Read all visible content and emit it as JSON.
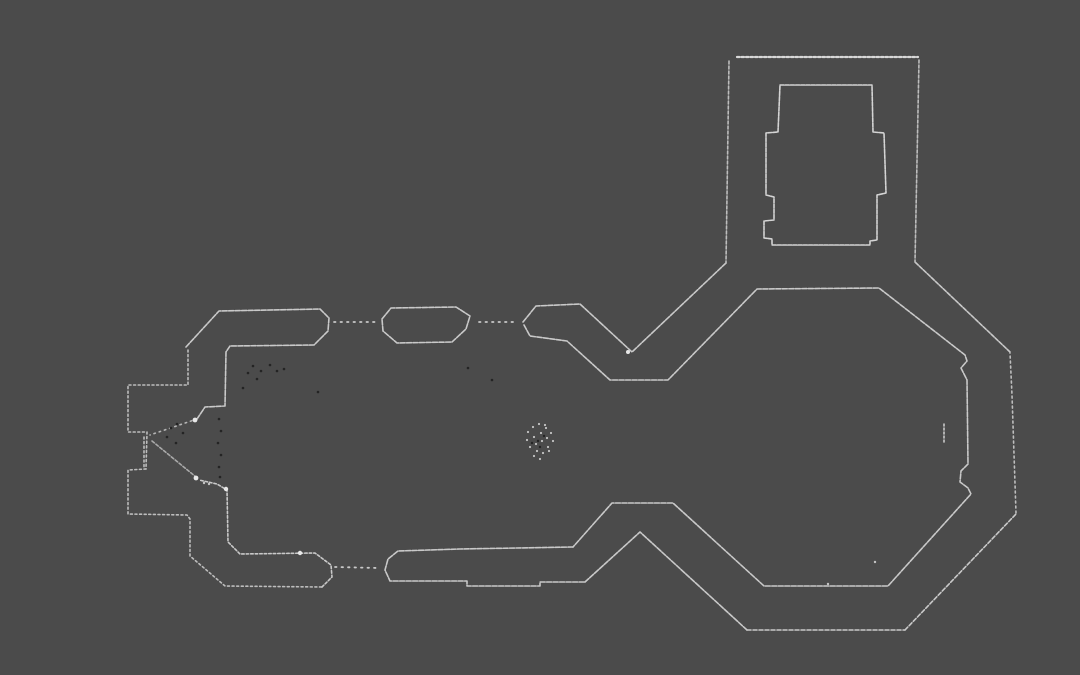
{
  "canvas": {
    "width": 1080,
    "height": 675,
    "background_color": "#4b4b4b",
    "wall_color": "#c9c9c9",
    "bright_color": "#e8e8e8",
    "noise_dark_color": "#242424",
    "noise_light_color": "#c4c4c4"
  },
  "map": {
    "walls": [
      {
        "name": "wall-nave-north-west-band",
        "dash": "5 1.5",
        "points": [
          [
            186,
            347
          ],
          [
            219,
            311
          ],
          [
            320,
            309
          ],
          [
            329,
            318
          ],
          [
            328,
            331
          ],
          [
            314,
            345
          ],
          [
            230,
            346
          ],
          [
            226,
            352
          ],
          [
            225,
            406
          ],
          [
            205,
            407
          ],
          [
            197,
            419
          ]
        ]
      },
      {
        "name": "wall-west-front-north-outer",
        "dash": "2 2.6",
        "color": "#bdbdbd",
        "points": [
          [
            188,
            350
          ],
          [
            188,
            385
          ],
          [
            128,
            385
          ],
          [
            128,
            432
          ],
          [
            147,
            432
          ],
          [
            146,
            469
          ]
        ]
      },
      {
        "name": "wall-west-front-south-outer",
        "dash": "2 2.6",
        "color": "#bdbdbd",
        "points": [
          [
            146,
            469
          ],
          [
            128,
            470
          ],
          [
            128,
            514
          ],
          [
            187,
            515
          ],
          [
            190,
            519
          ],
          [
            190,
            556
          ],
          [
            225,
            586
          ],
          [
            322,
            587
          ]
        ]
      },
      {
        "name": "wall-southwest-inner-cap",
        "dash": "2.5 2",
        "points": [
          [
            322,
            587
          ],
          [
            332,
            577
          ],
          [
            331,
            565
          ],
          [
            315,
            553
          ],
          [
            240,
            554
          ],
          [
            228,
            542
          ],
          [
            227,
            490
          ],
          [
            217,
            484
          ],
          [
            199,
            480
          ]
        ]
      },
      {
        "name": "west-door-leaf",
        "dash": "3 2",
        "color": "#a9a9a9",
        "points": [
          [
            152,
            441
          ],
          [
            196,
            477
          ]
        ]
      },
      {
        "name": "west-door-splay-top",
        "dash": "1.5 4",
        "color": "#b5b5b5",
        "points": [
          [
            197,
            419
          ],
          [
            150,
            435
          ]
        ]
      },
      {
        "name": "west-door-frame",
        "dash": "2 2.6",
        "color": "#bdbdbd",
        "points": [
          [
            144,
            437
          ],
          [
            144,
            468
          ]
        ]
      },
      {
        "name": "window-gap-dots-north-1",
        "dash": "1.5 5",
        "width": 1.8,
        "points": [
          [
            334,
            322
          ],
          [
            376,
            322
          ]
        ]
      },
      {
        "name": "window-pier-north",
        "dash": "5 1.5",
        "closed": true,
        "points": [
          [
            382,
            319
          ],
          [
            391,
            308
          ],
          [
            456,
            307
          ],
          [
            470,
            316
          ],
          [
            466,
            329
          ],
          [
            452,
            342
          ],
          [
            397,
            343
          ],
          [
            383,
            331
          ]
        ]
      },
      {
        "name": "window-gap-dots-north-2",
        "dash": "1.5 5",
        "width": 1.8,
        "points": [
          [
            479,
            322
          ],
          [
            518,
            322
          ]
        ]
      },
      {
        "name": "wall-nave-north-east-outer",
        "dash": "5 1.5",
        "points": [
          [
            523,
            322
          ],
          [
            536,
            306
          ],
          [
            580,
            304
          ],
          [
            632,
            352
          ],
          [
            726,
            263
          ]
        ]
      },
      {
        "name": "wall-octagon-inner-boundary",
        "dash": "5 1.5",
        "points": [
          [
            524,
            325
          ],
          [
            530,
            336
          ],
          [
            567,
            341
          ],
          [
            610,
            380
          ],
          [
            668,
            380
          ],
          [
            757,
            289
          ],
          [
            879,
            288
          ],
          [
            965,
            355
          ],
          [
            967,
            361
          ],
          [
            961,
            368
          ],
          [
            964,
            374
          ],
          [
            967,
            380
          ],
          [
            968,
            464
          ],
          [
            961,
            471
          ],
          [
            960,
            482
          ],
          [
            968,
            488
          ],
          [
            971,
            494
          ],
          [
            888,
            586
          ],
          [
            764,
            586
          ],
          [
            673,
            503
          ],
          [
            612,
            503
          ],
          [
            573,
            547
          ]
        ]
      },
      {
        "name": "wall-nave-south-band",
        "dash": "5 1.5",
        "points": [
          [
            573,
            547
          ],
          [
            460,
            549
          ],
          [
            398,
            551
          ],
          [
            388,
            559
          ],
          [
            385,
            570
          ],
          [
            390,
            581
          ],
          [
            467,
            581
          ],
          [
            467,
            586
          ],
          [
            540,
            586
          ],
          [
            540,
            582
          ],
          [
            585,
            582
          ]
        ]
      },
      {
        "name": "wall-octagon-outer-southwest",
        "dash": "5 1.5",
        "points": [
          [
            585,
            582
          ],
          [
            640,
            532
          ],
          [
            747,
            630
          ]
        ]
      },
      {
        "name": "wall-octagon-outer-south",
        "dash": "4 2",
        "points": [
          [
            747,
            630
          ],
          [
            905,
            630
          ]
        ]
      },
      {
        "name": "wall-octagon-outer-southeast",
        "dash": "4 2",
        "points": [
          [
            905,
            630
          ],
          [
            1016,
            514
          ]
        ]
      },
      {
        "name": "wall-octagon-outer-east",
        "dash": "2 3",
        "color": "#bdbdbd",
        "points": [
          [
            1016,
            513
          ],
          [
            1012,
            395
          ],
          [
            1010,
            353
          ]
        ]
      },
      {
        "name": "wall-octagon-outer-northeast",
        "dash": "4 1.5",
        "points": [
          [
            1010,
            352
          ],
          [
            915,
            262
          ]
        ]
      },
      {
        "name": "wall-tower-east",
        "dash": "3 2",
        "color": "#bdbdbd",
        "points": [
          [
            919,
            60
          ],
          [
            915,
            262
          ]
        ]
      },
      {
        "name": "wall-tower-north",
        "dash": "2.5 2",
        "width": 2.2,
        "color": "#d8d8d8",
        "points": [
          [
            737,
            57
          ],
          [
            918,
            57
          ]
        ]
      },
      {
        "name": "wall-tower-west",
        "dash": "3 2",
        "color": "#bdbdbd",
        "points": [
          [
            729,
            61
          ],
          [
            726,
            263
          ]
        ]
      },
      {
        "name": "tower-core-cross",
        "dash": "4 1.2",
        "color": "#d4d4d4",
        "closed": true,
        "points": [
          [
            780,
            85
          ],
          [
            872,
            85
          ],
          [
            873,
            132
          ],
          [
            884,
            133
          ],
          [
            886,
            193
          ],
          [
            877,
            195
          ],
          [
            877,
            240
          ],
          [
            870,
            241
          ],
          [
            870,
            245
          ],
          [
            772,
            245
          ],
          [
            772,
            239
          ],
          [
            764,
            238
          ],
          [
            764,
            221
          ],
          [
            774,
            220
          ],
          [
            774,
            197
          ],
          [
            766,
            195
          ],
          [
            766,
            133
          ],
          [
            778,
            132
          ]
        ]
      },
      {
        "name": "window-gap-dots-south",
        "dash": "1.5 5",
        "width": 1.8,
        "points": [
          [
            335,
            567
          ],
          [
            378,
            568
          ]
        ]
      },
      {
        "name": "apse-niche-bar",
        "dash": "2 2",
        "points": [
          [
            944,
            424
          ],
          [
            944,
            444
          ]
        ]
      }
    ],
    "blobs": [
      {
        "name": "door-blob-1",
        "x": 196,
        "y": 478,
        "r": 2.4
      },
      {
        "name": "door-blob-2",
        "x": 226,
        "y": 489,
        "r": 2.2
      },
      {
        "name": "door-blob-3",
        "x": 195,
        "y": 420,
        "r": 2.4
      },
      {
        "name": "waist-blob",
        "x": 628,
        "y": 352,
        "r": 2.0
      },
      {
        "name": "south-wall-blob",
        "x": 300,
        "y": 553,
        "r": 2.2
      }
    ],
    "speckle_groups": [
      {
        "name": "center-object-speckles-light",
        "kind": "light",
        "r": 1.1,
        "points": [
          [
            528,
            432
          ],
          [
            533,
            427
          ],
          [
            539,
            424
          ],
          [
            546,
            428
          ],
          [
            551,
            433
          ],
          [
            527,
            440
          ],
          [
            534,
            437
          ],
          [
            541,
            433
          ],
          [
            547,
            438
          ],
          [
            553,
            441
          ],
          [
            530,
            447
          ],
          [
            536,
            444
          ],
          [
            542,
            441
          ],
          [
            548,
            447
          ],
          [
            537,
            451
          ],
          [
            543,
            453
          ],
          [
            549,
            451
          ],
          [
            540,
            459
          ],
          [
            534,
            456
          ],
          [
            545,
            425
          ]
        ]
      },
      {
        "name": "center-object-speckles-dark",
        "kind": "dark",
        "r": 1.2,
        "points": [
          [
            538,
            441
          ],
          [
            532,
            443
          ],
          [
            544,
            436
          ],
          [
            540,
            447
          ]
        ]
      },
      {
        "name": "entrance-noise-dark",
        "kind": "dark",
        "r": 1.3,
        "points": [
          [
            171,
            428
          ],
          [
            177,
            424
          ],
          [
            183,
            433
          ],
          [
            167,
            437
          ],
          [
            176,
            443
          ],
          [
            219,
            419
          ],
          [
            221,
            431
          ],
          [
            218,
            443
          ],
          [
            221,
            455
          ],
          [
            219,
            467
          ],
          [
            220,
            477
          ],
          [
            253,
            366
          ],
          [
            261,
            371
          ],
          [
            270,
            365
          ],
          [
            277,
            371
          ],
          [
            248,
            373
          ],
          [
            257,
            379
          ],
          [
            284,
            369
          ],
          [
            243,
            388
          ],
          [
            318,
            392
          ],
          [
            468,
            368
          ],
          [
            492,
            380
          ]
        ]
      },
      {
        "name": "octagon-floor-dots",
        "kind": "light",
        "r": 1.2,
        "points": [
          [
            828,
            584
          ],
          [
            875,
            562
          ],
          [
            204,
            483
          ],
          [
            209,
            484
          ]
        ]
      }
    ]
  }
}
